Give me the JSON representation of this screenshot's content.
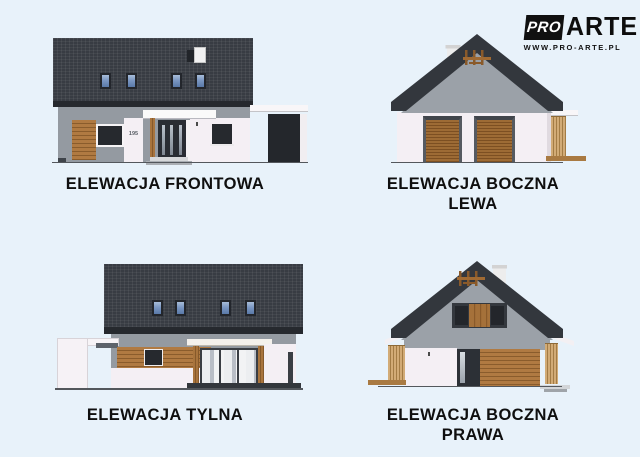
{
  "page": {
    "background_color": "#e8f2fa",
    "kind": "architectural elevation sheet"
  },
  "branding": {
    "logo_pro": "PRO",
    "logo_arte": "ARTE",
    "website": "WWW.PRO-ARTE.PL"
  },
  "front": {
    "label": "ELEWACJA FRONTOWA",
    "house_number": "195"
  },
  "side_left": {
    "label_line1": "ELEWACJA BOCZNA",
    "label_line2": "LEWA"
  },
  "rear": {
    "label": "ELEWACJA TYLNA"
  },
  "side_right": {
    "label_line1": "ELEWACJA BOCZNA",
    "label_line2": "PRAWA"
  },
  "colors": {
    "background": "#e8f2fa",
    "roof": "#383c43",
    "roof_fascia": "#26292e",
    "gable_wall": "#9ba1a8",
    "white_wall": "#f4eff4",
    "wood": "#a5713a",
    "wood_light": "#c9a06a",
    "roof_window_glass": "#7b97c2",
    "window_dark": "#2b2f35",
    "ground_line": "#53575c",
    "label_text": "#0f0f0f"
  }
}
